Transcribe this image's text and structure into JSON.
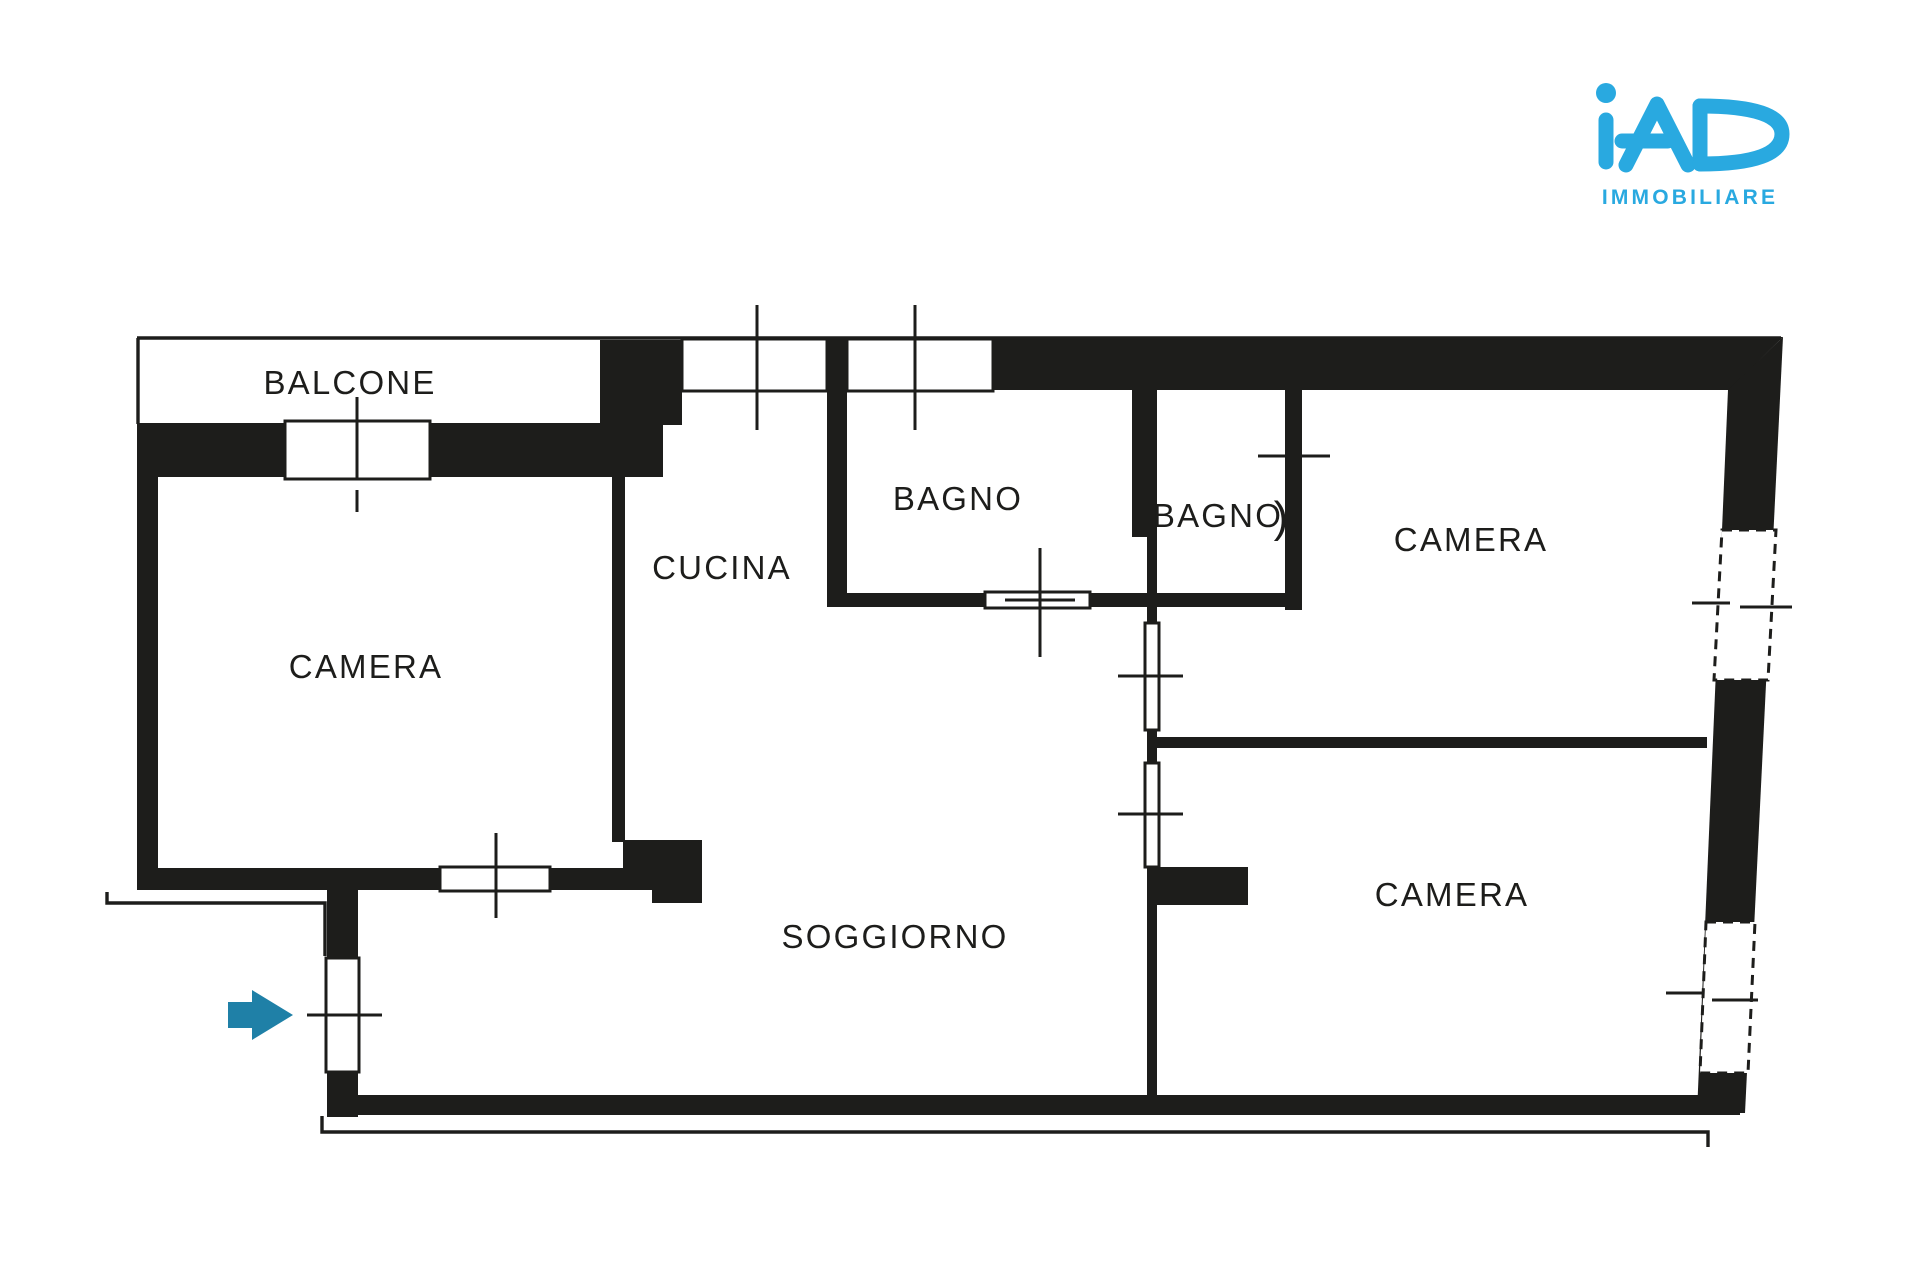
{
  "theme": {
    "ink": "#1d1d1b",
    "logo_blue": "#29A9E0",
    "arrow_teal": "#1F80A7",
    "background": "#ffffff"
  },
  "logo": {
    "brand": "iAD",
    "subtitle": "IMMOBILIARE"
  },
  "floorplan": {
    "type": "apartment-floor-plan",
    "entrance_arrow": {
      "direction": "right"
    },
    "door_arc_glyph": ")",
    "rooms": [
      {
        "id": "balcone",
        "label": "BALCONE"
      },
      {
        "id": "camera-left",
        "label": "CAMERA"
      },
      {
        "id": "cucina",
        "label": "CUCINA"
      },
      {
        "id": "bagno-1",
        "label": "BAGNO"
      },
      {
        "id": "bagno-2",
        "label": "BAGNO"
      },
      {
        "id": "camera-top-right",
        "label": "CAMERA"
      },
      {
        "id": "soggiorno",
        "label": "SOGGIORNO"
      },
      {
        "id": "camera-bottom-right",
        "label": "CAMERA"
      }
    ]
  }
}
